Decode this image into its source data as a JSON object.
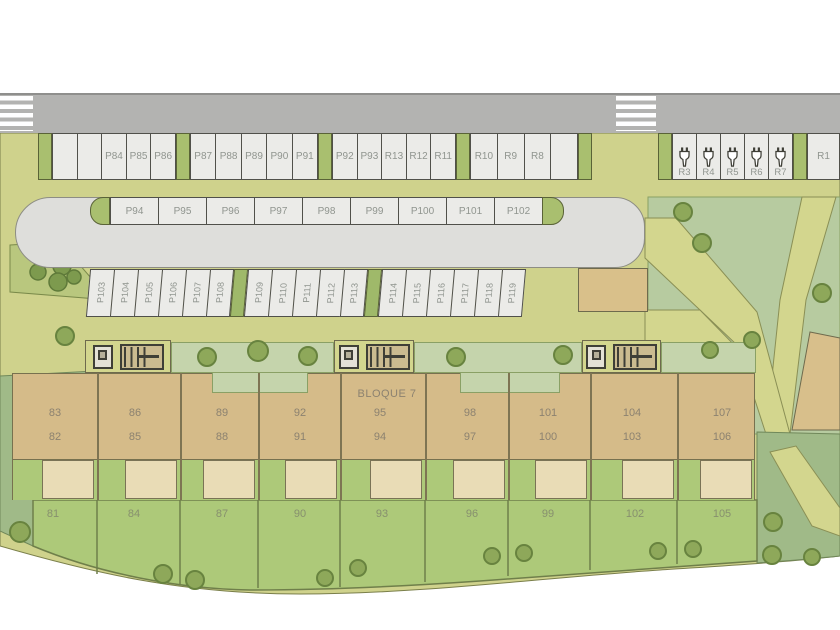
{
  "plan": {
    "block_label": "BLOQUE 7",
    "parking": {
      "row_top": [
        [
          "",
          "",
          "P84",
          "P85",
          "P86"
        ],
        [
          "P87",
          "P88",
          "P89",
          "P90",
          "P91"
        ],
        [
          "P92",
          "P93",
          "R13",
          "R12",
          "R11"
        ],
        [
          "R10",
          "R9",
          "R8",
          ""
        ],
        [
          "R3",
          "R4",
          "R5",
          "R6",
          "R7"
        ],
        [
          "R1"
        ]
      ],
      "island": [
        "P94",
        "P95",
        "P96",
        "P97",
        "P98",
        "P99",
        "P100",
        "P101",
        "P102"
      ],
      "lower": [
        "P103",
        "P104",
        "P105",
        "P106",
        "P107",
        "P108",
        "P109",
        "P110",
        "P111",
        "P112",
        "P113",
        "P114",
        "P115",
        "P116",
        "P117",
        "P118",
        "P119"
      ]
    },
    "building": {
      "upper": [
        "83",
        "86",
        "89",
        "92",
        "95",
        "98",
        "101",
        "104",
        "107"
      ],
      "lower": [
        "82",
        "85",
        "88",
        "91",
        "94",
        "97",
        "100",
        "103",
        "106"
      ],
      "garden": [
        "81",
        "84",
        "87",
        "90",
        "93",
        "96",
        "99",
        "102",
        "105"
      ]
    },
    "colors": {
      "road": "#b3b3b1",
      "site_green": "#cfd28c",
      "park_green": "#b7cba0",
      "garden_green": "#adc979",
      "building_tan": "#d5bb89",
      "stall_fill": "#ebebe8",
      "cap_green": "#a9bf6f"
    }
  }
}
